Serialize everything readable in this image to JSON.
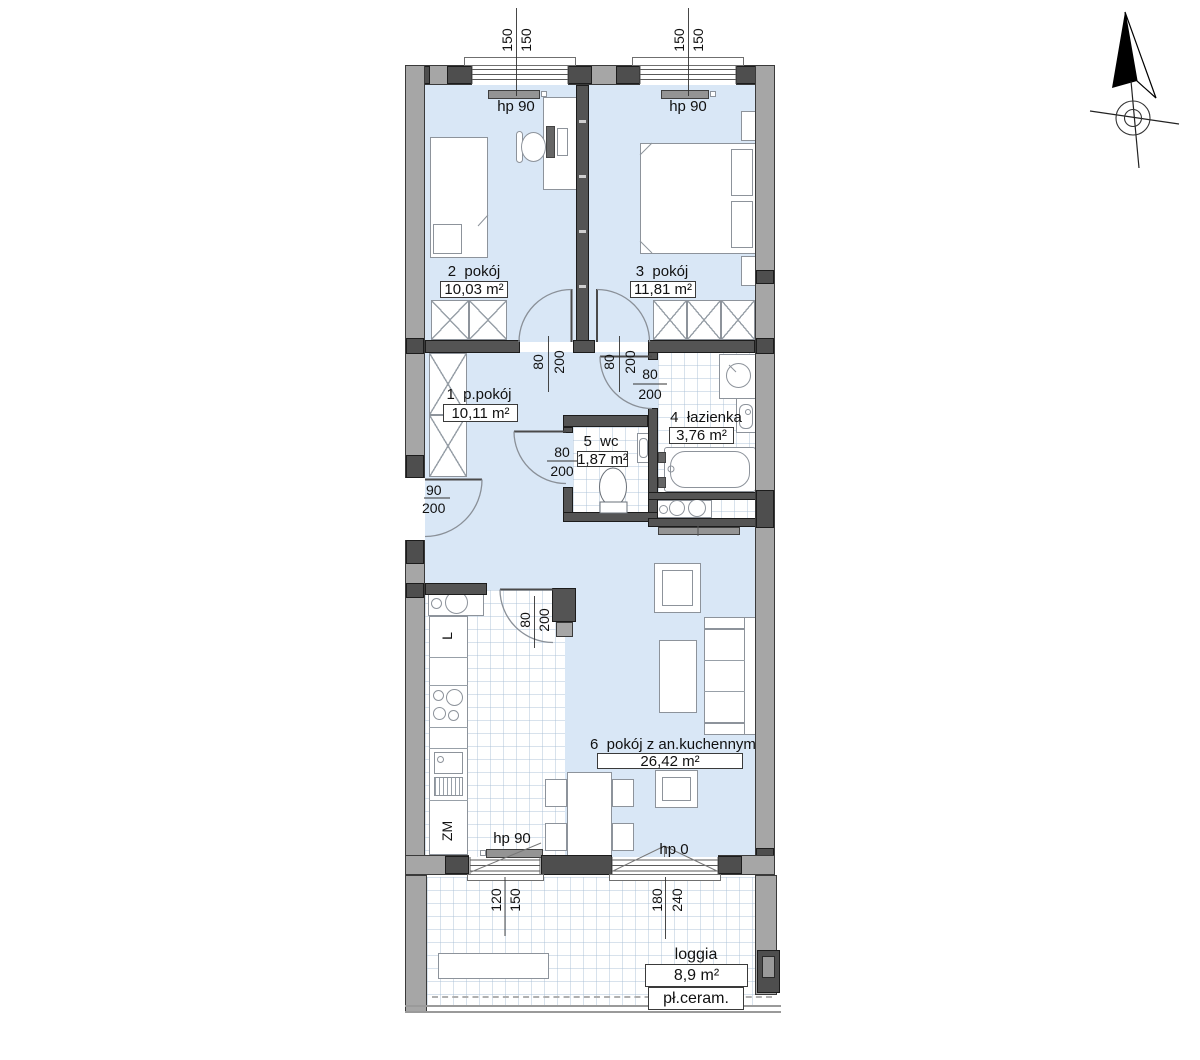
{
  "rooms": {
    "r1": {
      "name": "1  p.pokój",
      "area": "10,11 m²"
    },
    "r2": {
      "name": "2  pokój",
      "area": "10,03 m²"
    },
    "r3": {
      "name": "3  pokój",
      "area": "11,81 m²"
    },
    "r4": {
      "name": "4  łazienka",
      "area": "3,76 m²"
    },
    "r5": {
      "name": "5  wc",
      "area": "1,87 m²"
    },
    "r6": {
      "name": "6  pokój z an.kuchennym",
      "area": "26,42 m²"
    },
    "loggia": {
      "name": "loggia",
      "area": "8,9 m²",
      "finish": "pł.ceram."
    }
  },
  "radiator_labels": {
    "hp90": "hp 90",
    "hp0": "hp 0"
  },
  "appliance_labels": {
    "fridge": "L",
    "dishwasher": "ZM"
  },
  "dims": {
    "win_top_left": {
      "w": "150",
      "h": "150"
    },
    "win_top_right": {
      "w": "150",
      "h": "150"
    },
    "door_r2": {
      "w": "80",
      "h": "200"
    },
    "door_r3": {
      "w": "80",
      "h": "200"
    },
    "door_bath": {
      "w": "80",
      "h": "200"
    },
    "door_wc": {
      "w": "80",
      "h": "200"
    },
    "door_entry": {
      "w": "90",
      "h": "200"
    },
    "door_kitchen": {
      "w": "80",
      "h": "200"
    },
    "win_bottom": {
      "w": "120",
      "h": "150"
    },
    "door_balcony": {
      "w": "180",
      "h": "240"
    }
  },
  "colors": {
    "room_fill": "#d9e7f6",
    "wall_interior": "#545454",
    "wall_exterior": "#a6a6a6",
    "marker_magenta": "#ff3ae0"
  }
}
